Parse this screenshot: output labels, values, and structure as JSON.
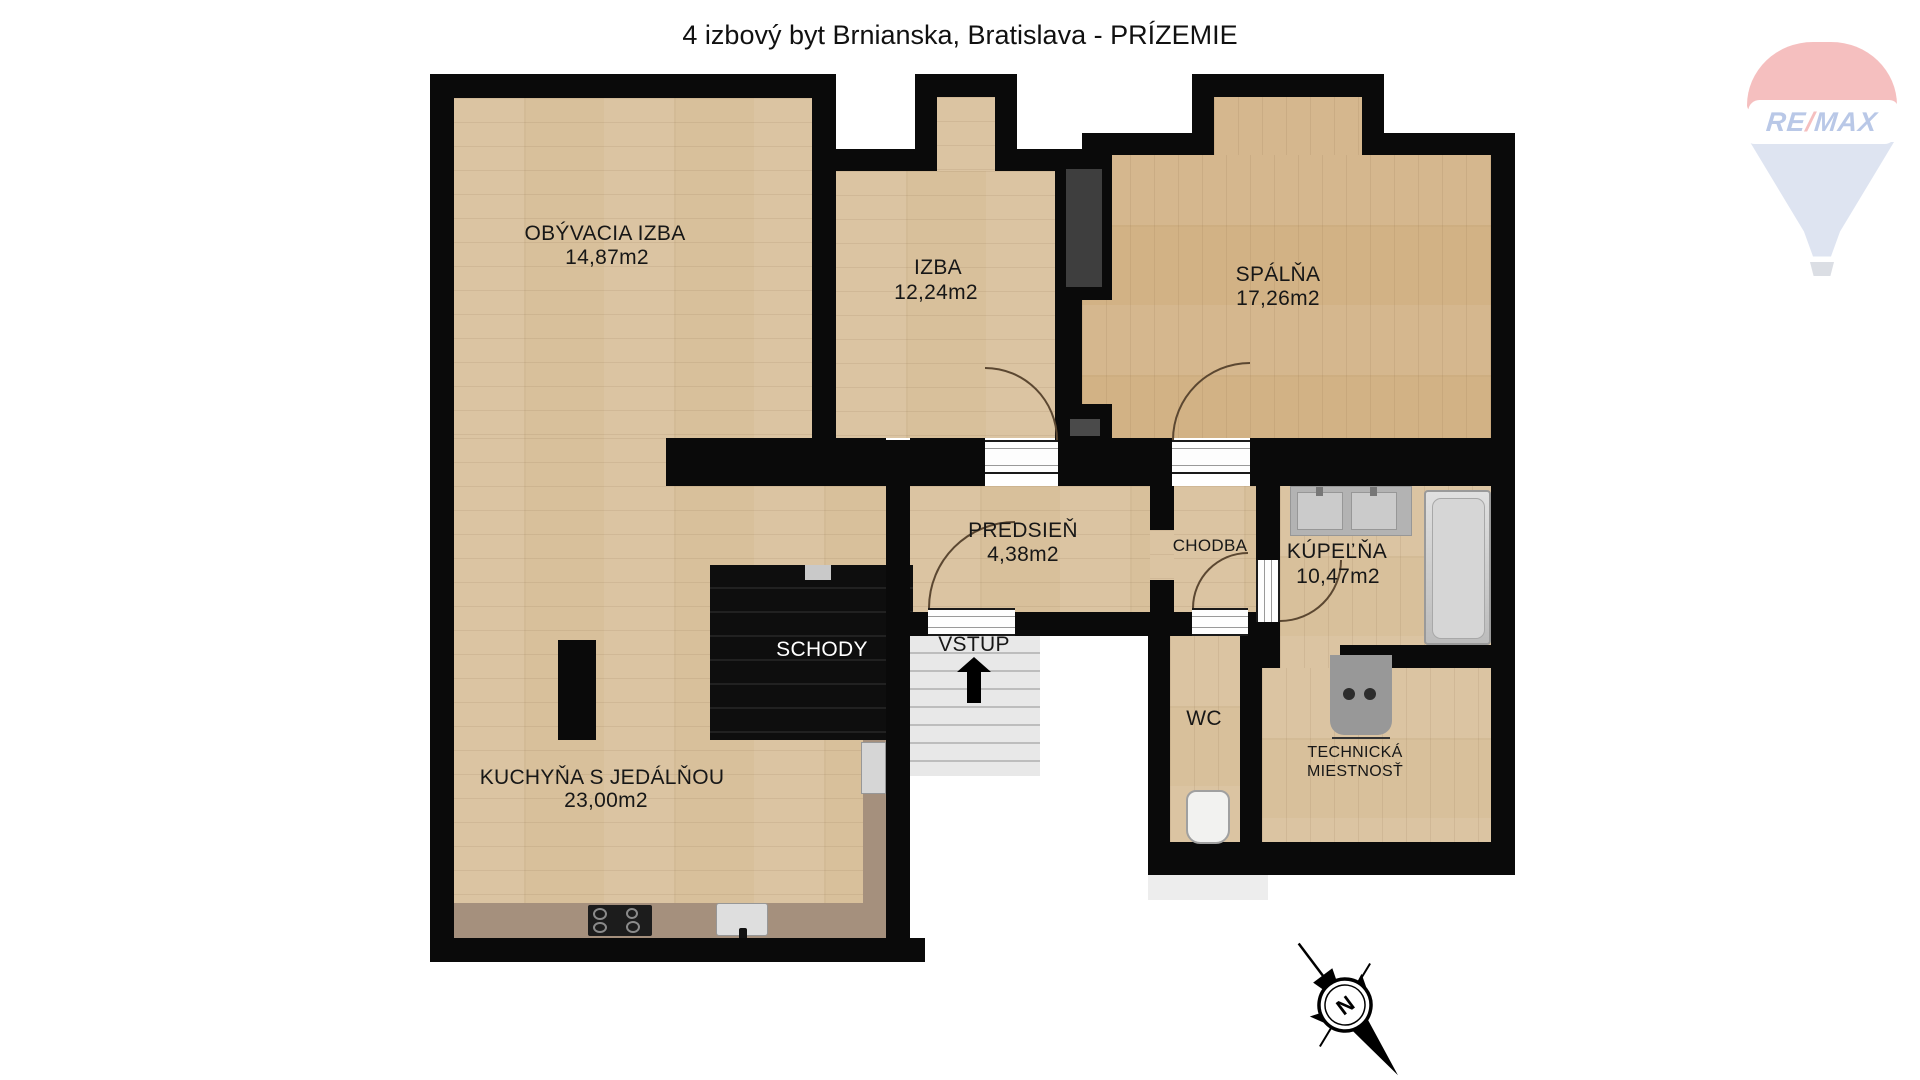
{
  "title": "4 izbový byt Brnianska, Bratislava - PRÍZEMIE",
  "watermark": {
    "text_re": "RE",
    "text_slash": "/",
    "text_max": "MAX"
  },
  "compass": {
    "north_label": "N"
  },
  "rooms": {
    "obyvacia": {
      "name": "OBÝVACIA IZBA",
      "area": "14,87m2"
    },
    "izba": {
      "name": "IZBA",
      "area": "12,24m2"
    },
    "spalna": {
      "name": "SPÁLŇA",
      "area": "17,26m2"
    },
    "predsien": {
      "name": "PREDSIEŇ",
      "area": "4,38m2"
    },
    "chodba": {
      "name": "CHODBA"
    },
    "kupelna": {
      "name": "KÚPEĽŇA",
      "area": "10,47m2"
    },
    "kuchyna": {
      "name": "KUCHYŇA S JEDÁLŇOU",
      "area": "23,00m2"
    },
    "wc": {
      "name": "WC"
    },
    "technicka": {
      "name": "TECHNICKÁ",
      "name_line2": "MIESTNOSŤ"
    },
    "schody": {
      "name": "SCHODY"
    },
    "vstup": {
      "name": "VSTUP"
    }
  },
  "colors": {
    "wall": "#0a0a0a",
    "wood_light": "#d8c09b",
    "wood_bedroom": "#d2b285",
    "counter": "#a5907d",
    "stairs": "#e8e8e8",
    "shaft": "#3e3e3e",
    "remax_red": "#e03030",
    "remax_blue": "#1b4db3",
    "remax_balloon_blue": "#93a7d4"
  }
}
